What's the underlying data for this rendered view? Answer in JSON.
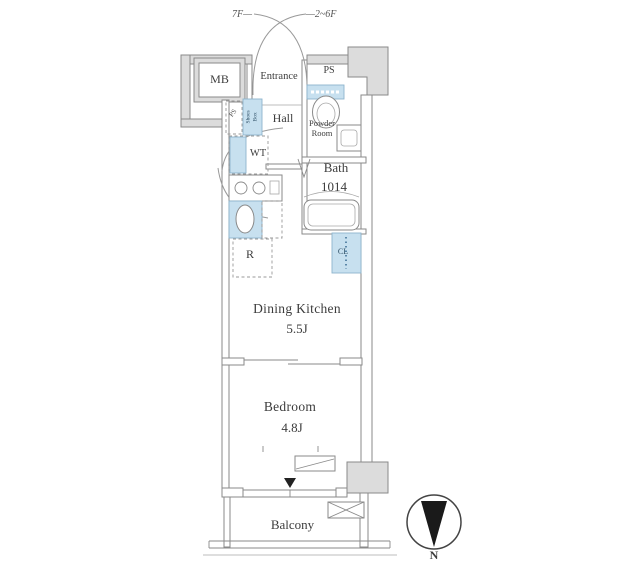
{
  "plan": {
    "labels": {
      "floor_left": "7F—",
      "floor_right": "—2~6F",
      "mb": "MB",
      "entrance": "Entrance",
      "ps_top": "PS",
      "ps_small": "PS",
      "shoes_box_line1": "Shoes",
      "shoes_box_line2": "Box",
      "hall": "Hall",
      "powder_room_line1": "Powder",
      "powder_room_line2": "Room",
      "bath": "Bath",
      "bath_size": "1014",
      "washer": "WT",
      "fridge": "R",
      "closet": "CL",
      "dining_kitchen": "Dining Kitchen",
      "dining_kitchen_size": "5.5J",
      "bedroom": "Bedroom",
      "bedroom_size": "4.8J",
      "balcony": "Balcony",
      "compass_north": "N"
    },
    "colors": {
      "wall_fill": "#dcdcdc",
      "line": "#8a8a8a",
      "fixture_fill": "#c7e0ef",
      "fixture_line": "#8db4cd",
      "text": "#3c3c3c",
      "compass": "#1a1a1a"
    }
  }
}
